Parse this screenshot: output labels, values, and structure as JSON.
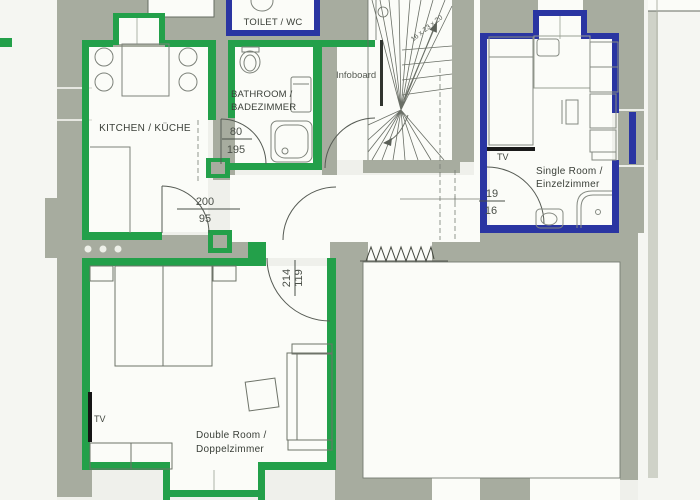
{
  "plan": {
    "rooms": {
      "kitchen": {
        "label": "KITCHEN / KÜCHE"
      },
      "bathroom": {
        "label_line1": "BATHROOM /",
        "label_line2": "BADEZIMMER"
      },
      "toilet": {
        "label": "TOILET / WC"
      },
      "single_room": {
        "label_line1": "Single Room /",
        "label_line2": "Einzelzimmer",
        "tv": "TV"
      },
      "double_room": {
        "label_line1": "Double Room /",
        "label_line2": "Doppelzimmer",
        "tv": "TV"
      }
    },
    "annotations": {
      "infoboard": "Infoboard",
      "stair_dimensions": "16 x 23 x 20"
    },
    "door_dimensions": {
      "bathroom": {
        "top": "80",
        "bottom": "195"
      },
      "kitchen_hall": {
        "top": "200",
        "bottom": "95"
      },
      "single_room": {
        "top": "19",
        "bottom": "16"
      },
      "double_room": {
        "first": "214",
        "second": "119"
      }
    },
    "colors": {
      "apartment_green_outline": "#23a04a",
      "apartment_blue_outline": "#2a35a2",
      "wall_fill": "#a7ac9f",
      "room_fill": "#fbfcf8"
    }
  }
}
